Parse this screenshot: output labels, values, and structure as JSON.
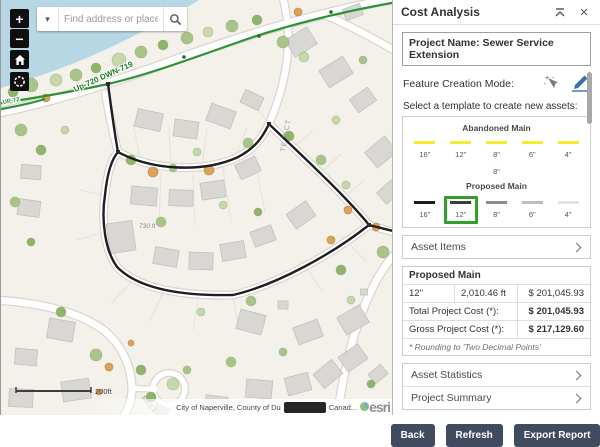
{
  "map": {
    "search": {
      "placeholder": "Find address or place"
    },
    "controls": {
      "zoom_in": "+",
      "zoom_out": "−"
    },
    "scale_label": "200ft",
    "attribution_left": "City of Naperville, County of Du",
    "attribution_right": "Canad...",
    "esri": "esri",
    "labels": [
      {
        "text": "Up-720 DWN-719",
        "x": 74,
        "y": 92,
        "rot": -24,
        "cls": "lbl-green"
      },
      {
        "text": "UP-72",
        "x": 2,
        "y": 104,
        "rot": -10,
        "cls": "lbl-green-sm"
      },
      {
        "text": "TE 2 CT",
        "x": 284,
        "y": 152,
        "rot": -80,
        "cls": "lbl-street"
      },
      {
        "text": "MIST",
        "x": 140,
        "y": 398,
        "rot": 52,
        "cls": "lbl-street"
      },
      {
        "text": "730 ft",
        "x": 138,
        "y": 228,
        "rot": 0,
        "cls": "lbl-measure"
      }
    ],
    "geometry": {
      "bg": "#f3f1ea",
      "water": {
        "d": "M0,0 L198,0 C165,20 120,44 76,62 C46,74 20,82 0,88 Z",
        "color": "#b8d7e5"
      },
      "road_casing": "#d9d6ce",
      "roads": [
        {
          "d": "M-5,113 C60,100 125,78 185,56 C245,35 315,13 397,-2",
          "w": 8
        },
        {
          "d": "M104,92 C108,114 112,133 117,152",
          "w": 6.5
        },
        {
          "d": "M117,152 C150,170 200,173 235,158 C256,148 263,134 268,124 C295,150 345,196 368,225 C330,255 275,285 232,295 C185,296 140,290 117,268 C104,252 100,220 104,195 C106,175 110,160 117,152 Z",
          "w": 6.5
        },
        {
          "d": "M268,124 C280,96 289,64 287,28 C286,16 284,6 282,-2",
          "w": 6.5
        },
        {
          "d": "M368,225 C378,228 385,230 396,233",
          "w": 6.5
        },
        {
          "d": "M396,252 C372,276 348,330 336,418",
          "w": 7
        },
        {
          "d": "M-5,300 C40,303 80,312 105,332 C122,347 130,367 131,388 C131,400 128,408 122,418",
          "w": 7
        },
        {
          "d": "M131,388 C141,389 150,389 156,389",
          "w": 5
        },
        {
          "d": "M320,13 C350,26 372,38 396,52",
          "w": 6.5
        }
      ],
      "culdesac": {
        "cx": 168,
        "cy": 389,
        "r": 16
      },
      "parcels": [
        "M140,165 L132,122",
        "M170,172 L168,126",
        "M200,172 L206,128",
        "M232,160 L246,128",
        "M268,124 L252,102",
        "M292,148 L312,130",
        "M318,174 L340,154",
        "M342,198 L364,180",
        "M232,295 L238,330",
        "M198,294 L192,330",
        "M163,290 L148,322",
        "M133,279 L110,304",
        "M104,195 L78,190",
        "M103,232 L76,240",
        "M160,172 L158,224",
        "M192,173 L194,226",
        "M222,167 L230,222",
        "M252,150 L264,212",
        "M300,260 L322,292",
        "M340,236 L366,262"
      ],
      "parcel_color": "#e6e2d8",
      "buildings": [
        [
          148,
          120,
          26,
          18,
          12
        ],
        [
          185,
          129,
          24,
          17,
          8
        ],
        [
          220,
          116,
          26,
          18,
          20
        ],
        [
          251,
          100,
          20,
          14,
          25
        ],
        [
          300,
          42,
          26,
          20,
          -32
        ],
        [
          335,
          72,
          28,
          20,
          -32
        ],
        [
          362,
          100,
          22,
          16,
          -35
        ],
        [
          352,
          12,
          18,
          12,
          -20
        ],
        [
          380,
          152,
          26,
          20,
          -40
        ],
        [
          388,
          192,
          20,
          15,
          -42
        ],
        [
          143,
          196,
          26,
          18,
          5
        ],
        [
          180,
          198,
          24,
          16,
          2
        ],
        [
          212,
          190,
          24,
          17,
          -8
        ],
        [
          247,
          168,
          22,
          16,
          -25
        ],
        [
          120,
          237,
          26,
          30,
          -8
        ],
        [
          165,
          257,
          24,
          17,
          10
        ],
        [
          200,
          261,
          24,
          17,
          2
        ],
        [
          232,
          251,
          24,
          17,
          -10
        ],
        [
          262,
          236,
          22,
          16,
          -20
        ],
        [
          300,
          215,
          24,
          18,
          -35
        ],
        [
          28,
          208,
          22,
          16,
          8
        ],
        [
          30,
          172,
          20,
          14,
          4
        ],
        [
          250,
          322,
          26,
          20,
          15
        ],
        [
          307,
          332,
          26,
          18,
          -20
        ],
        [
          352,
          320,
          26,
          20,
          -30
        ],
        [
          352,
          358,
          24,
          18,
          -35
        ],
        [
          327,
          374,
          24,
          18,
          -40
        ],
        [
          297,
          384,
          24,
          18,
          -15
        ],
        [
          258,
          389,
          26,
          18,
          5
        ],
        [
          377,
          374,
          16,
          12,
          -40
        ],
        [
          60,
          330,
          26,
          20,
          10
        ],
        [
          25,
          357,
          22,
          16,
          5
        ],
        [
          75,
          390,
          28,
          20,
          -8
        ],
        [
          20,
          398,
          24,
          18,
          3
        ],
        [
          215,
          404,
          22,
          16,
          8
        ],
        [
          160,
          411,
          14,
          10,
          30
        ],
        [
          282,
          305,
          10,
          8,
          0
        ],
        [
          363,
          292,
          7,
          6,
          0
        ]
      ],
      "building_fill": "#d8d7d3",
      "building_stroke": "#c2c1bc",
      "tree_palette": [
        "#a9c489",
        "#8fb56d",
        "#c6d8aa",
        "#dfa057"
      ],
      "trees": [
        [
          30,
          85,
          7,
          0
        ],
        [
          55,
          80,
          6,
          2
        ],
        [
          12,
          92,
          5,
          1
        ],
        [
          75,
          75,
          6,
          0
        ],
        [
          95,
          68,
          5,
          1
        ],
        [
          118,
          60,
          7,
          2
        ],
        [
          140,
          52,
          6,
          0
        ],
        [
          162,
          45,
          5,
          1
        ],
        [
          186,
          38,
          6,
          0
        ],
        [
          207,
          32,
          5,
          2
        ],
        [
          231,
          26,
          6,
          0
        ],
        [
          256,
          20,
          5,
          1
        ],
        [
          282,
          42,
          6,
          0
        ],
        [
          303,
          57,
          5,
          2
        ],
        [
          20,
          130,
          6,
          0
        ],
        [
          40,
          150,
          5,
          1
        ],
        [
          64,
          130,
          4,
          2
        ],
        [
          14,
          202,
          5,
          0
        ],
        [
          30,
          242,
          4,
          1
        ],
        [
          130,
          160,
          5,
          1
        ],
        [
          172,
          168,
          4,
          0
        ],
        [
          196,
          152,
          4,
          2
        ],
        [
          247,
          143,
          5,
          0
        ],
        [
          288,
          136,
          5,
          1
        ],
        [
          222,
          205,
          4,
          2
        ],
        [
          160,
          222,
          5,
          0
        ],
        [
          257,
          212,
          4,
          1
        ],
        [
          320,
          160,
          5,
          0
        ],
        [
          345,
          185,
          4,
          2
        ],
        [
          382,
          252,
          6,
          0
        ],
        [
          340,
          270,
          5,
          1
        ],
        [
          250,
          301,
          5,
          0
        ],
        [
          200,
          312,
          4,
          2
        ],
        [
          60,
          312,
          5,
          1
        ],
        [
          95,
          355,
          6,
          0
        ],
        [
          140,
          370,
          5,
          1
        ],
        [
          172,
          384,
          6,
          2
        ],
        [
          186,
          370,
          4,
          0
        ],
        [
          150,
          397,
          5,
          1
        ],
        [
          230,
          362,
          5,
          0
        ],
        [
          350,
          300,
          4,
          2
        ],
        [
          370,
          384,
          4,
          1
        ],
        [
          282,
          352,
          4,
          0
        ],
        [
          335,
          120,
          4,
          2
        ],
        [
          362,
          60,
          4,
          0
        ]
      ],
      "orange_trees": [
        [
          45,
          98,
          4
        ],
        [
          152,
          172,
          5
        ],
        [
          208,
          170,
          5
        ],
        [
          297,
          12,
          4
        ],
        [
          347,
          210,
          4
        ],
        [
          330,
          240,
          4
        ],
        [
          108,
          367,
          4
        ],
        [
          98,
          392,
          3
        ],
        [
          130,
          343,
          3
        ],
        [
          375,
          227,
          4
        ]
      ],
      "green_line": {
        "color": "#2f9138",
        "paths": [
          "M-5,104 C40,97 70,92 107,84 C150,74 200,55 252,37 C302,21 350,10 396,2",
          "M-5,110 C12,107 28,104 44,99"
        ],
        "dots": [
          [
            107,
            84
          ],
          [
            183,
            57
          ],
          [
            258,
            36
          ],
          [
            330,
            12
          ]
        ]
      },
      "trace": {
        "color": "#1f1f1f",
        "paths": [
          "M107,84 C110,106 113,130 117,152",
          "M117,152 C150,170 200,173 235,158 C256,148 263,134 268,124 C295,150 345,196 368,225 C330,255 275,285 232,295 C185,296 140,290 117,268 C104,252 100,220 104,195 C106,175 110,160 117,152 Z",
          "M368,225 L392,231"
        ],
        "nodes": [
          [
            107,
            84
          ],
          [
            117,
            152
          ],
          [
            268,
            124
          ],
          [
            368,
            225
          ]
        ]
      },
      "scalebar": {
        "x1": 15,
        "x2": 90,
        "y": 391
      }
    }
  },
  "panel": {
    "title": "Cost Analysis",
    "close": "✕",
    "project_name": "Project Name: Sewer Service Extension",
    "feature_creation_mode_label": "Feature Creation Mode:",
    "template_label": "Select a template to create new assets:",
    "groups": [
      {
        "name": "Abandoned Main",
        "items": [
          {
            "label": "16\"",
            "color": "#f6ec2d"
          },
          {
            "label": "12\"",
            "color": "#f6ec2d"
          },
          {
            "label": "8\"",
            "color": "#f6ec2d"
          },
          {
            "label": "6\"",
            "color": "#f6ec2d"
          },
          {
            "label": "4\"",
            "color": "#f6ec2d"
          }
        ],
        "extra": {
          "label": "8\"",
          "color": "#fffef2"
        }
      },
      {
        "name": "Proposed Main",
        "items": [
          {
            "label": "16\"",
            "color": "#1c1c1c"
          },
          {
            "label": "12\"",
            "color": "#3d3d3d"
          },
          {
            "label": "8\"",
            "color": "#8c8c8c"
          },
          {
            "label": "6\"",
            "color": "#bdbdbd"
          },
          {
            "label": "4\"",
            "color": "#e3e3e3"
          }
        ]
      },
      {
        "name": "Proposed Valves"
      }
    ],
    "selection_color": "#33a02c",
    "accordions": {
      "asset_items": "Asset Items",
      "asset_statistics": "Asset Statistics",
      "project_summary": "Project Summary"
    },
    "cost_table": {
      "header": "Proposed Main",
      "row": {
        "size": "12\"",
        "length": "2,010.46 ft",
        "cost": "$ 201,045.93"
      },
      "total_label": "Total Project Cost (*):",
      "total_value": "$ 201,045.93",
      "gross_label": "Gross Project Cost (*):",
      "gross_value": "$ 217,129.60",
      "note": "* Rounding to 'Two Decimal Points'"
    },
    "buttons": {
      "back": "Back",
      "refresh": "Refresh",
      "export": "Export Report"
    }
  }
}
